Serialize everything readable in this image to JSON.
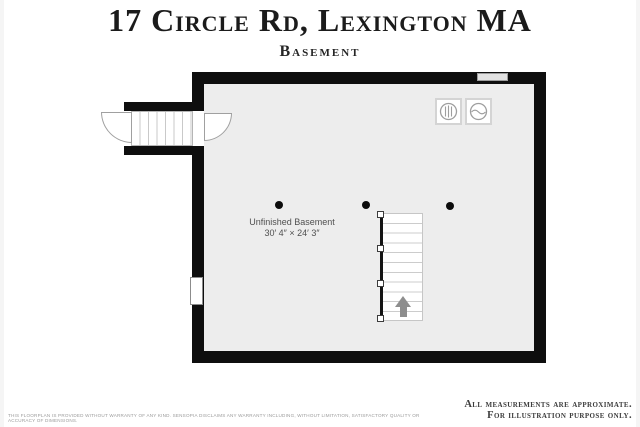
{
  "page": {
    "title": "17 Circle Rd, Lexington MA",
    "subtitle": "Basement"
  },
  "floorplan": {
    "room_label": {
      "name": "Unfinished Basement",
      "dimensions": "30′ 4″ × 24′ 3″"
    },
    "icons": {
      "washer": "washer-icon",
      "dryer": "dryer-icon",
      "stairs_direction": "up-arrow-icon",
      "columns": "support-column-dot",
      "exterior_entry": "bulkhead-stairs-with-door-swings",
      "windows": "window-symbol"
    },
    "colors": {
      "wall": "#0e0e0e",
      "floor": "#ededed",
      "stair_tread": "#cccccc",
      "arrow": "#8d8d8d"
    }
  },
  "footer": {
    "approx_line1": "All measurements are approximate.",
    "approx_line2": "For illustration purpose only.",
    "disclaimer": "This floorplan is provided without warranty of any kind. Sensopia disclaims any warranty including, without limitation, satisfactory quality or accuracy of dimensions."
  }
}
